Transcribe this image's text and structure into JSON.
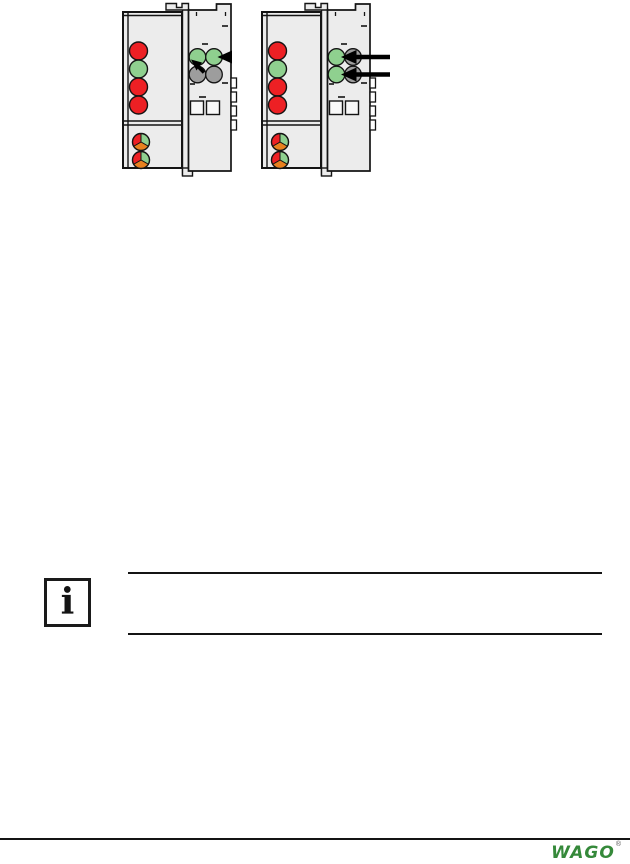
{
  "figure": {
    "description": "Two fieldbus node drawings showing LED indicator positions",
    "colors": {
      "body": "#ececec",
      "outline": "#141414",
      "led_red": "#ed2024",
      "led_green": "#8fd08f",
      "led_gray": "#9d9d9d",
      "led_orange": "#e8811f",
      "arrow_black": "#000000",
      "square_fill": "#f8f8f8",
      "contact_fill": "#ffffff"
    },
    "devices": [
      {
        "name": "fieldbus-node-left",
        "status_leds": [
          "red",
          "green",
          "red",
          "red"
        ],
        "io_led_grid": [
          [
            "green",
            "green"
          ],
          [
            "gray",
            "gray"
          ]
        ],
        "power_leds": [
          "red/green/orange",
          "red/green/orange"
        ],
        "annotation": "arrowheads point to the two upper green I/O LEDs"
      },
      {
        "name": "fieldbus-node-right",
        "status_leds": [
          "red",
          "green",
          "red",
          "red"
        ],
        "io_led_grid": [
          [
            "green",
            "gray"
          ],
          [
            "green",
            "gray"
          ]
        ],
        "power_leds": [
          "red/green/orange",
          "red/green/orange"
        ],
        "annotation": "two horizontal arrows point to the left-column green I/O LEDs"
      }
    ]
  },
  "note": {
    "icon_glyph": "i"
  },
  "footer": {
    "logo_text": "WAGO",
    "logo_color": "#35893a",
    "registered_mark": "®"
  }
}
